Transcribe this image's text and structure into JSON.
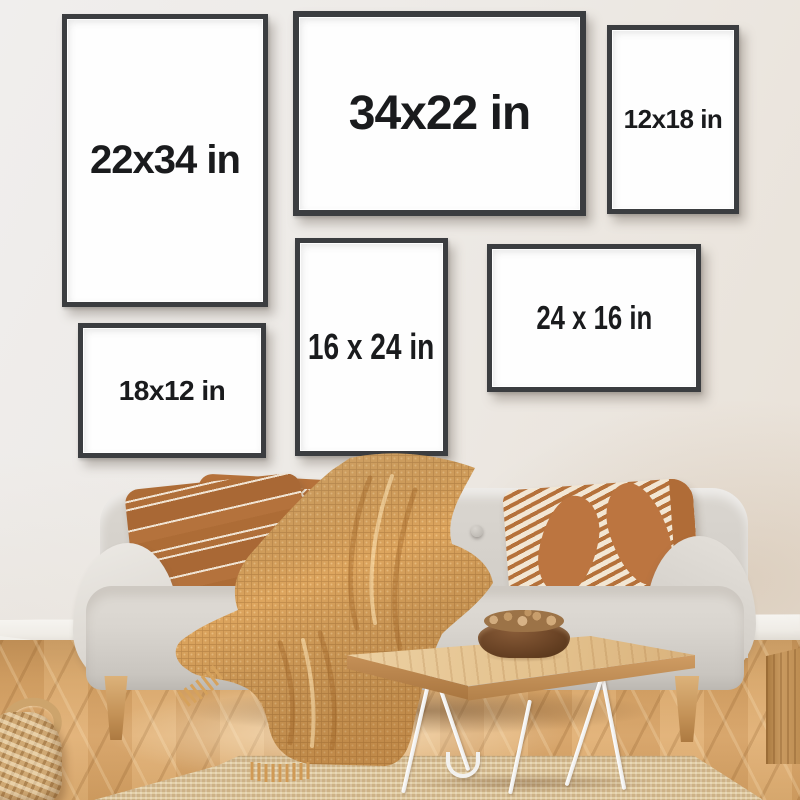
{
  "scene": {
    "description": "Living-room wall mockup showing six black poster frames with size labels above a light gray sofa"
  },
  "frames": [
    {
      "label": "22x34 in",
      "orientation": "portrait"
    },
    {
      "label": "34x22 in",
      "orientation": "landscape"
    },
    {
      "label": "12x18 in",
      "orientation": "portrait"
    },
    {
      "label": "16 x 24 in",
      "orientation": "portrait"
    },
    {
      "label": "24 x 16 in",
      "orientation": "landscape"
    },
    {
      "label": "18x12 in",
      "orientation": "landscape"
    }
  ],
  "colors": {
    "wall": "#edeae6",
    "frame_border": "#3b3d40",
    "frame_paper": "#fefefe",
    "label_text": "#1a1b1d",
    "sofa": "#d5d1cb",
    "blanket": "#dca45f",
    "pillow_caramel": "#b5713a",
    "floor_wood": "#d2a064",
    "rug_jute": "#d6bd92",
    "table_wood": "#e4c28e",
    "hairpin_legs": "#f2f1ef",
    "bowl": "#6b4426"
  }
}
